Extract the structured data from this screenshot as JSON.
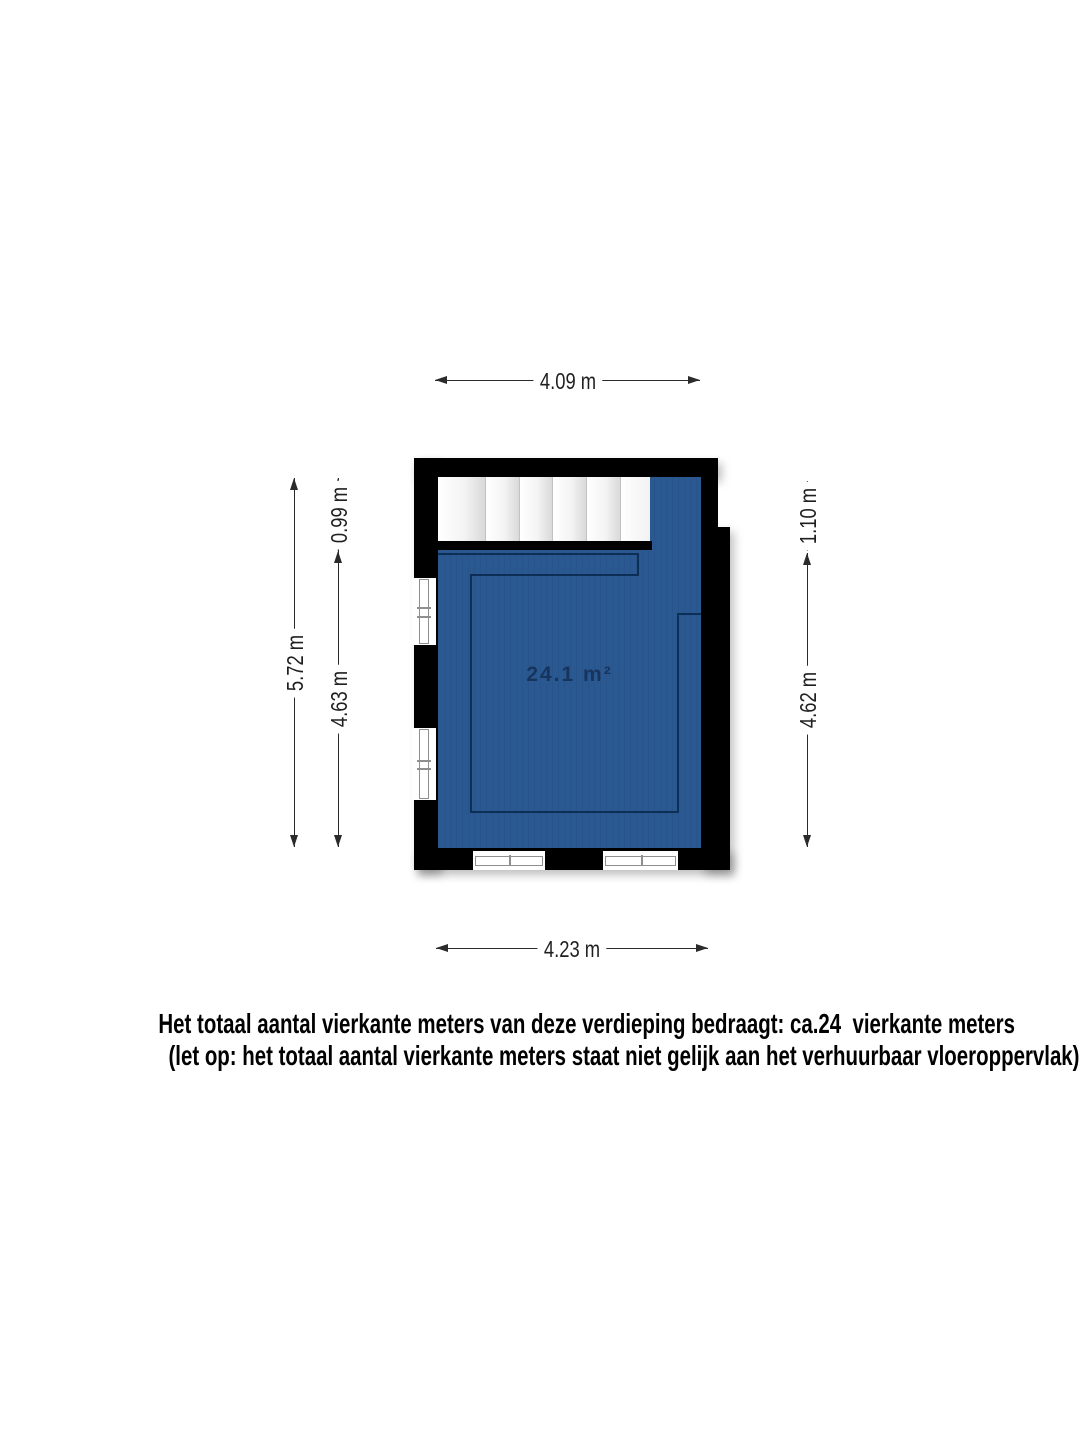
{
  "floorplan": {
    "area_label": "24.1 m²",
    "dim_top": "4.09 m",
    "dim_bottom": "4.23 m",
    "dim_left_outer": "5.72 m",
    "dim_left_top": "0.99 m",
    "dim_left_bottom": "4.63 m",
    "dim_right_top": "1.10 m",
    "dim_right_bottom": "4.62 m",
    "colors": {
      "floor": "#2a5891",
      "wall": "#000000",
      "room_outline": "#0e2f55",
      "dimension_line": "#2b2b2b",
      "stair_divider": "#c2c2c2"
    }
  },
  "footer": {
    "line1": "Het totaal aantal vierkante meters van deze verdieping bedraagt: ca.24  vierkante meters",
    "line2": "(let op: het totaal aantal vierkante meters staat niet gelijk aan het verhuurbaar vloeroppervlak)"
  }
}
